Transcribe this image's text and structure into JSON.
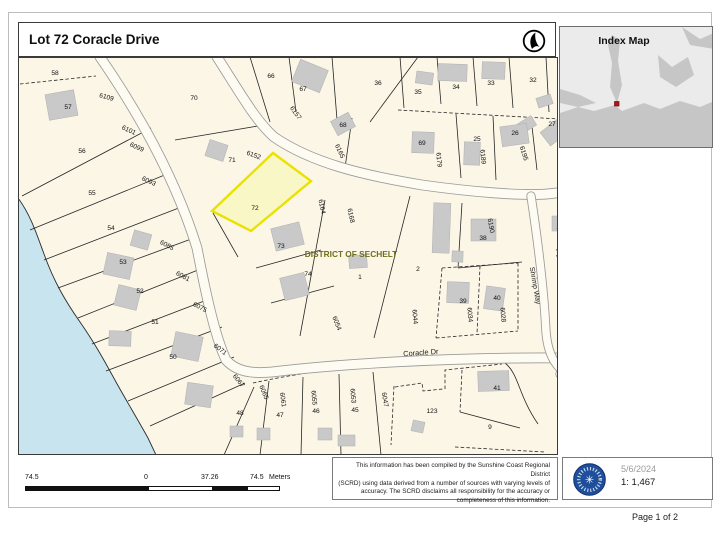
{
  "page": {
    "title": "Lot 72 Coracle Drive",
    "page_label": "Page 1 of 2"
  },
  "index_map": {
    "title": "Index Map",
    "marker_color": "#b31515"
  },
  "footer": {
    "date": "5/6/2024",
    "scale": "1: 1,467",
    "disclaimer_lines": [
      "This information has been compiled by the Sunshine Coast Regional District",
      "(SCRD) using data derived from a number of sources with varying levels of",
      "accuracy.  The SCRD disclaims all responsibility for the accuracy or",
      "completeness of this information."
    ],
    "scalebar": {
      "labels": [
        {
          "t": "74.5",
          "x": 25
        },
        {
          "t": "0",
          "x": 144
        },
        {
          "t": "37.26",
          "x": 201
        },
        {
          "t": "74.5",
          "x": 250
        },
        {
          "t": "Meters",
          "x": 269
        }
      ],
      "segments": [
        {
          "x": 25,
          "w": 123,
          "fill": "#111"
        },
        {
          "x": 148,
          "w": 65,
          "fill": "#fff"
        },
        {
          "x": 213,
          "w": 34,
          "fill": "#111"
        },
        {
          "x": 247,
          "w": 33,
          "fill": "#fff"
        }
      ]
    }
  },
  "map": {
    "bg": "#fbf6e6",
    "water_fill": "#c8e4ef",
    "water_path": "M18,198 C30,214 36,232 44,254 C54,282 66,302 80,322 C94,342 104,360 116,382 C126,400 138,420 148,438 L156,455 L18,455 Z",
    "shore_path": "M18,198 C30,214 36,232 44,254 C54,282 66,302 80,322 C94,342 104,360 116,382 C126,400 138,420 148,438 L156,455",
    "highlight": {
      "points": "273,153 311,181 251,231 212,211",
      "fill": "#faf7c6",
      "stroke": "#e8e200",
      "stroke_width": 2.4
    },
    "green_fill": "#8bc871",
    "green_polys": [
      "633,171 680,146 697,151 695,212 661,216",
      "638,222 668,225 650,288 626,261"
    ],
    "roads": [
      {
        "d": "M100,57 C140,115 176,180 197,248 C206,295 215,336 226,360 C236,371 250,374 272,372 C340,364 450,357 562,358",
        "w": 9
      },
      {
        "d": "M217,57 C242,96 256,121 274,137 C312,163 362,175 422,185 C472,192 522,196 547,194 C605,189 662,158 718,134",
        "w": 9
      },
      {
        "d": "M531,196 C538,242 544,292 546,332 C548,356 556,369 574,379",
        "w": 7.5
      },
      {
        "d": "M714,213 C682,240 642,290 602,340 C588,357 578,368 570,377",
        "w": 7.5
      },
      {
        "d": "M560,374 C592,396 632,420 670,441 L705,453",
        "w": 7.5
      }
    ],
    "parcels": [
      {
        "d": "M20,84 L96,76",
        "dash": true
      },
      {
        "d": "M151,128 L22,196"
      },
      {
        "d": "M172,172 L30,230"
      },
      {
        "d": "M184,206 L44,260"
      },
      {
        "d": "M194,238 L58,288"
      },
      {
        "d": "M203,268 L78,318"
      },
      {
        "d": "M212,298 L92,344"
      },
      {
        "d": "M222,327 L106,371"
      },
      {
        "d": "M234,357 L128,401"
      },
      {
        "d": "M245,383 L150,426"
      },
      {
        "d": "M254,387 L224,455"
      },
      {
        "d": "M269,381 L260,455"
      },
      {
        "d": "M303,377 L301,455"
      },
      {
        "d": "M339,374 L341,455"
      },
      {
        "d": "M373,372 L381,455"
      },
      {
        "d": "M253,383 C330,366 420,360 462,358",
        "dash": true
      },
      {
        "d": "M394,386 L391,445",
        "dash": true
      },
      {
        "d": "M395,387 L422,383 L423,391 L443,389",
        "dash": true
      },
      {
        "d": "M445,389 L445,370 L502,364",
        "dash": true
      },
      {
        "d": "M462,370 L460,412",
        "dash": true
      },
      {
        "d": "M505,363 C519,374 518,395 538,424"
      },
      {
        "d": "M460,412 L520,428"
      },
      {
        "d": "M455,447 L545,452",
        "dash": true
      },
      {
        "d": "M325,200 L300,336"
      },
      {
        "d": "M410,196 L374,338"
      },
      {
        "d": "M256,268 L321,250"
      },
      {
        "d": "M271,303 L334,286"
      },
      {
        "d": "M213,213 L238,257"
      },
      {
        "d": "M462,203 L458,268"
      },
      {
        "d": "M458,268 L522,262"
      },
      {
        "d": "M442,268 L518,263",
        "dash": true
      },
      {
        "d": "M442,268 L436,338",
        "dash": true
      },
      {
        "d": "M436,338 L518,331",
        "dash": true
      },
      {
        "d": "M480,266 L477,334",
        "dash": true
      },
      {
        "d": "M518,263 L518,331",
        "dash": true
      },
      {
        "d": "M250,57 L270,122"
      },
      {
        "d": "M289,57 L296,112"
      },
      {
        "d": "M332,57 L338,132"
      },
      {
        "d": "M370,122 L418,57"
      },
      {
        "d": "M400,57 L404,108"
      },
      {
        "d": "M437,57 L441,104"
      },
      {
        "d": "M473,57 L477,106"
      },
      {
        "d": "M509,57 L513,108"
      },
      {
        "d": "M546,57 L549,112"
      },
      {
        "d": "M398,110 L560,119",
        "dash": true
      },
      {
        "d": "M456,114 L461,178"
      },
      {
        "d": "M493,116 L496,180"
      },
      {
        "d": "M531,118 L537,170"
      },
      {
        "d": "M352,118 L345,168"
      },
      {
        "d": "M175,140 L258,126"
      },
      {
        "d": "M557,202 C610,184 660,163 705,144",
        "dash": true
      },
      {
        "d": "M578,196 L582,244"
      },
      {
        "d": "M611,181 L617,234"
      },
      {
        "d": "M556,250 L626,237",
        "dash": true
      },
      {
        "d": "M556,256 L612,247",
        "dash": true
      },
      {
        "d": "M560,358 L586,372",
        "dash": true
      },
      {
        "d": "M650,342 L716,329",
        "dash": true
      },
      {
        "d": "M605,385 L662,371",
        "dash": true
      },
      {
        "d": "M662,371 L653,442"
      },
      {
        "d": "M664,400 L716,391",
        "dash": true
      },
      {
        "d": "M688,248 L658,312",
        "dash": true
      },
      {
        "d": "M648,168 L628,204"
      },
      {
        "d": "M616,234 L650,228"
      }
    ],
    "buildings": [
      {
        "x": 47,
        "y": 92,
        "w": 29,
        "h": 26,
        "r": -10
      },
      {
        "x": 207,
        "y": 142,
        "w": 19,
        "h": 17,
        "r": 18
      },
      {
        "x": 295,
        "y": 64,
        "w": 30,
        "h": 24,
        "r": 22
      },
      {
        "x": 333,
        "y": 116,
        "w": 20,
        "h": 16,
        "r": -28
      },
      {
        "x": 416,
        "y": 72,
        "w": 17,
        "h": 12,
        "r": 8
      },
      {
        "x": 438,
        "y": 64,
        "w": 29,
        "h": 17,
        "r": 2
      },
      {
        "x": 482,
        "y": 62,
        "w": 23,
        "h": 17,
        "r": 2
      },
      {
        "x": 519,
        "y": 119,
        "w": 16,
        "h": 11,
        "r": -32
      },
      {
        "x": 543,
        "y": 124,
        "w": 22,
        "h": 17,
        "r": -38
      },
      {
        "x": 537,
        "y": 96,
        "w": 15,
        "h": 10,
        "r": -18
      },
      {
        "x": 412,
        "y": 132,
        "w": 22,
        "h": 21,
        "r": 2
      },
      {
        "x": 464,
        "y": 142,
        "w": 16,
        "h": 23,
        "r": 2
      },
      {
        "x": 501,
        "y": 125,
        "w": 27,
        "h": 20,
        "r": -8
      },
      {
        "x": 552,
        "y": 216,
        "w": 22,
        "h": 15,
        "r": 0
      },
      {
        "x": 577,
        "y": 214,
        "w": 14,
        "h": 12,
        "r": 6
      },
      {
        "x": 597,
        "y": 202,
        "w": 20,
        "h": 22,
        "r": 6
      },
      {
        "x": 105,
        "y": 255,
        "w": 27,
        "h": 22,
        "r": 12
      },
      {
        "x": 116,
        "y": 287,
        "w": 23,
        "h": 21,
        "r": 14
      },
      {
        "x": 109,
        "y": 331,
        "w": 22,
        "h": 15,
        "r": 2
      },
      {
        "x": 173,
        "y": 334,
        "w": 28,
        "h": 25,
        "r": 12
      },
      {
        "x": 132,
        "y": 232,
        "w": 18,
        "h": 16,
        "r": 16
      },
      {
        "x": 186,
        "y": 384,
        "w": 26,
        "h": 22,
        "r": 8
      },
      {
        "x": 273,
        "y": 225,
        "w": 29,
        "h": 23,
        "r": -14
      },
      {
        "x": 282,
        "y": 275,
        "w": 25,
        "h": 23,
        "r": -14
      },
      {
        "x": 349,
        "y": 255,
        "w": 18,
        "h": 13,
        "r": -4
      },
      {
        "x": 433,
        "y": 203,
        "w": 17,
        "h": 50,
        "r": 2
      },
      {
        "x": 452,
        "y": 251,
        "w": 11,
        "h": 11,
        "r": 2
      },
      {
        "x": 471,
        "y": 219,
        "w": 25,
        "h": 22,
        "r": 0
      },
      {
        "x": 447,
        "y": 282,
        "w": 22,
        "h": 21,
        "r": 2
      },
      {
        "x": 485,
        "y": 287,
        "w": 19,
        "h": 23,
        "r": 8
      },
      {
        "x": 564,
        "y": 295,
        "w": 25,
        "h": 27,
        "r": 2
      },
      {
        "x": 478,
        "y": 371,
        "w": 31,
        "h": 20,
        "r": -2
      },
      {
        "x": 412,
        "y": 421,
        "w": 12,
        "h": 11,
        "r": 12
      },
      {
        "x": 230,
        "y": 426,
        "w": 13,
        "h": 11,
        "r": 0
      },
      {
        "x": 257,
        "y": 428,
        "w": 13,
        "h": 12,
        "r": 0
      },
      {
        "x": 318,
        "y": 428,
        "w": 14,
        "h": 12,
        "r": 0
      },
      {
        "x": 338,
        "y": 435,
        "w": 17,
        "h": 11,
        "r": 0
      },
      {
        "x": 627,
        "y": 398,
        "w": 17,
        "h": 12,
        "r": 38
      }
    ],
    "labels": [
      {
        "t": "58",
        "x": 55,
        "y": 75
      },
      {
        "t": "57",
        "x": 68,
        "y": 109
      },
      {
        "t": "6109",
        "x": 106,
        "y": 99,
        "r": 15
      },
      {
        "t": "70",
        "x": 194,
        "y": 100
      },
      {
        "t": "66",
        "x": 271,
        "y": 78
      },
      {
        "t": "67",
        "x": 303,
        "y": 91
      },
      {
        "t": "6157",
        "x": 294,
        "y": 114,
        "r": 55
      },
      {
        "t": "36",
        "x": 378,
        "y": 85
      },
      {
        "t": "35",
        "x": 418,
        "y": 94
      },
      {
        "t": "34",
        "x": 456,
        "y": 89
      },
      {
        "t": "33",
        "x": 491,
        "y": 85
      },
      {
        "t": "32",
        "x": 533,
        "y": 82
      },
      {
        "t": "27",
        "x": 552,
        "y": 126
      },
      {
        "t": "26",
        "x": 515,
        "y": 135
      },
      {
        "t": "6195",
        "x": 522,
        "y": 154,
        "r": 72
      },
      {
        "t": "25",
        "x": 477,
        "y": 141
      },
      {
        "t": "6189",
        "x": 481,
        "y": 157,
        "r": 85
      },
      {
        "t": "69",
        "x": 422,
        "y": 145
      },
      {
        "t": "6179",
        "x": 437,
        "y": 160,
        "r": 85
      },
      {
        "t": "68",
        "x": 343,
        "y": 127
      },
      {
        "t": "6165",
        "x": 338,
        "y": 152,
        "r": 65
      },
      {
        "t": "71",
        "x": 232,
        "y": 162
      },
      {
        "t": "6152",
        "x": 253,
        "y": 157,
        "r": 20
      },
      {
        "t": "56",
        "x": 82,
        "y": 153
      },
      {
        "t": "6101",
        "x": 128,
        "y": 132,
        "r": 25
      },
      {
        "t": "6099",
        "x": 136,
        "y": 149,
        "r": 25
      },
      {
        "t": "55",
        "x": 92,
        "y": 195
      },
      {
        "t": "6093",
        "x": 148,
        "y": 183,
        "r": 25
      },
      {
        "t": "54",
        "x": 111,
        "y": 230
      },
      {
        "t": "6085",
        "x": 166,
        "y": 247,
        "r": 28
      },
      {
        "t": "53",
        "x": 123,
        "y": 264
      },
      {
        "t": "6081",
        "x": 182,
        "y": 278,
        "r": 28
      },
      {
        "t": "52",
        "x": 140,
        "y": 293
      },
      {
        "t": "6075",
        "x": 199,
        "y": 309,
        "r": 28
      },
      {
        "t": "51",
        "x": 155,
        "y": 324
      },
      {
        "t": "50",
        "x": 173,
        "y": 359
      },
      {
        "t": "6071",
        "x": 219,
        "y": 351,
        "r": 38
      },
      {
        "t": "72",
        "x": 255,
        "y": 210
      },
      {
        "t": "6164",
        "x": 320,
        "y": 207,
        "r": 78
      },
      {
        "t": "6168",
        "x": 349,
        "y": 216,
        "r": 78
      },
      {
        "t": "73",
        "x": 281,
        "y": 248
      },
      {
        "t": "74",
        "x": 308,
        "y": 276
      },
      {
        "t": "1",
        "x": 360,
        "y": 279
      },
      {
        "t": "2",
        "x": 418,
        "y": 271
      },
      {
        "t": "38",
        "x": 483,
        "y": 240
      },
      {
        "t": "6190",
        "x": 489,
        "y": 226,
        "r": 80
      },
      {
        "t": "39",
        "x": 463,
        "y": 303
      },
      {
        "t": "6034",
        "x": 468,
        "y": 315,
        "r": 85
      },
      {
        "t": "40",
        "x": 497,
        "y": 300
      },
      {
        "t": "6028",
        "x": 501,
        "y": 315,
        "r": 85
      },
      {
        "t": "6054",
        "x": 335,
        "y": 324,
        "r": 68
      },
      {
        "t": "6044",
        "x": 413,
        "y": 317,
        "r": 85
      },
      {
        "t": "6067",
        "x": 237,
        "y": 382,
        "r": 52
      },
      {
        "t": "6065",
        "x": 262,
        "y": 393,
        "r": 68
      },
      {
        "t": "48",
        "x": 240,
        "y": 415
      },
      {
        "t": "6061",
        "x": 281,
        "y": 400,
        "r": 82
      },
      {
        "t": "47",
        "x": 280,
        "y": 417
      },
      {
        "t": "6055",
        "x": 312,
        "y": 398,
        "r": 85
      },
      {
        "t": "46",
        "x": 316,
        "y": 413
      },
      {
        "t": "6053",
        "x": 351,
        "y": 396,
        "r": 85
      },
      {
        "t": "45",
        "x": 355,
        "y": 412
      },
      {
        "t": "6047",
        "x": 383,
        "y": 400,
        "r": 80
      },
      {
        "t": "123",
        "x": 432,
        "y": 413
      },
      {
        "t": "41",
        "x": 497,
        "y": 390
      },
      {
        "t": "9",
        "x": 490,
        "y": 429
      },
      {
        "t": "22",
        "x": 634,
        "y": 200
      },
      {
        "t": "23",
        "x": 594,
        "y": 216
      },
      {
        "t": "6209",
        "x": 588,
        "y": 201,
        "r": 85
      },
      {
        "t": "24",
        "x": 560,
        "y": 229
      },
      {
        "t": "78",
        "x": 592,
        "y": 306
      },
      {
        "t": "6858",
        "x": 570,
        "y": 309,
        "r": 15
      },
      {
        "t": "112",
        "x": 676,
        "y": 317
      },
      {
        "t": "111",
        "x": 667,
        "y": 366
      },
      {
        "t": "6019",
        "x": 639,
        "y": 378,
        "r": 45
      },
      {
        "t": "C",
        "x": 631,
        "y": 397
      },
      {
        "t": "A",
        "x": 674,
        "y": 422
      },
      {
        "t": "2",
        "x": 594,
        "y": 439
      },
      {
        "t": "Coracle Dr",
        "x": 421,
        "y": 355,
        "r": -4,
        "s": 7.4,
        "c": "#1b1b1b"
      },
      {
        "t": "Shrimp Way",
        "x": 533,
        "y": 286,
        "r": 80,
        "s": 7,
        "c": "#1b1b1b"
      },
      {
        "t": "Sandy Hook Rd",
        "x": 630,
        "y": 338,
        "r": -45,
        "s": 7.4,
        "c": "#1b1b1b"
      },
      {
        "t": "Sandy Hook Tr",
        "x": 604,
        "y": 428,
        "r": -28,
        "s": 7,
        "c": "#1b1b1b"
      },
      {
        "t": "DISTRICT OF SECHELT",
        "x": 351,
        "y": 257,
        "s": 8.3,
        "b": 1,
        "c": "#6f6f1d"
      }
    ]
  }
}
